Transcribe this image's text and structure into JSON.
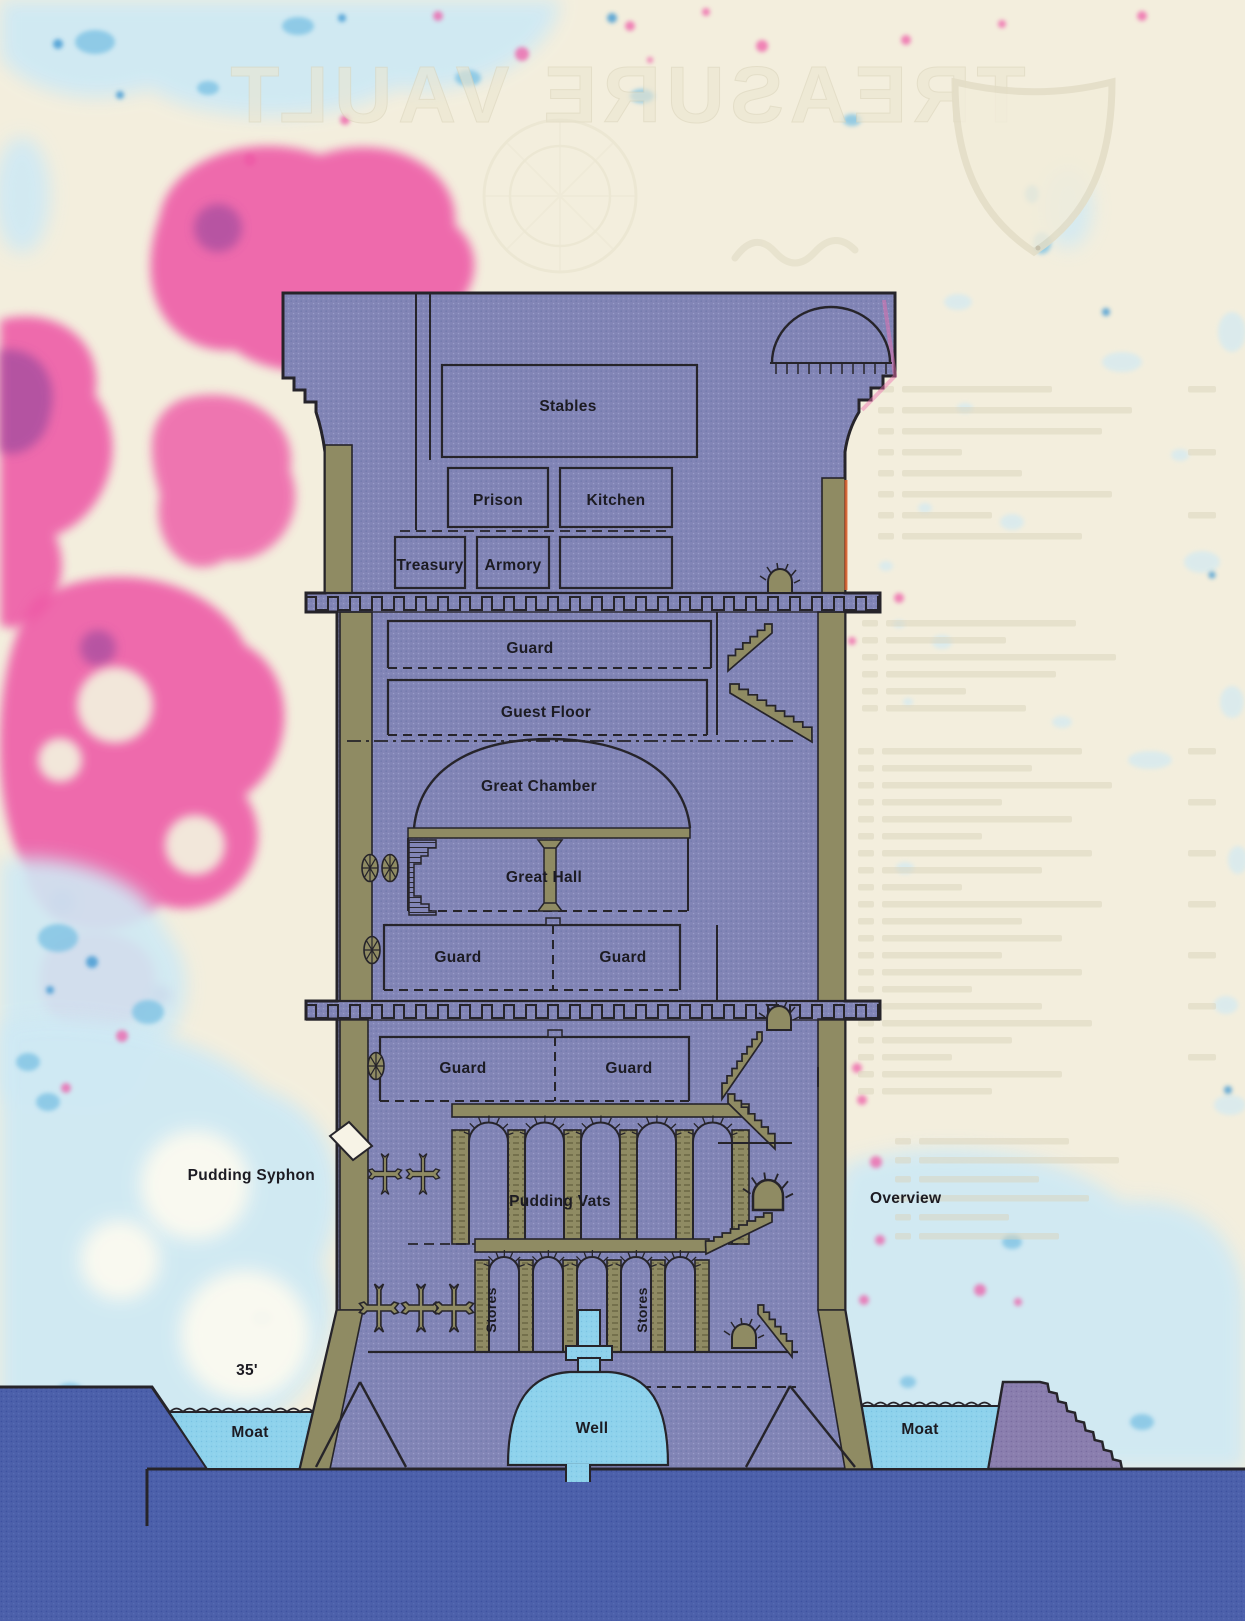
{
  "palette": {
    "paper": "#f3eedd",
    "tower_purple": "#8285b6",
    "wall_khaki": "#8f8b63",
    "water_blue": "#8ed2ec",
    "ground_blue": "#4c60aa",
    "ink": "#26242a",
    "splotch_pink": "#ee58a6",
    "splotch_blue": "#7fc3e4"
  },
  "ghost": {
    "title": "TREASURE VAULT"
  },
  "labels": {
    "stables": "Stables",
    "prison": "Prison",
    "kitchen": "Kitchen",
    "treasury": "Treasury",
    "armory": "Armory",
    "guard_upper": "Guard",
    "guest_floor": "Guest Floor",
    "great_chamber": "Great Chamber",
    "great_hall": "Great Hall",
    "guard_mid_left": "Guard",
    "guard_mid_right": "Guard",
    "guard_low_left": "Guard",
    "guard_low_right": "Guard",
    "pudding_syphon": "Pudding Syphon",
    "pudding_vats": "Pudding Vats",
    "overview": "Overview",
    "stores_left": "Stores",
    "stores_right": "Stores",
    "height": "35'",
    "moat_left": "Moat",
    "well": "Well",
    "moat_right": "Moat"
  }
}
